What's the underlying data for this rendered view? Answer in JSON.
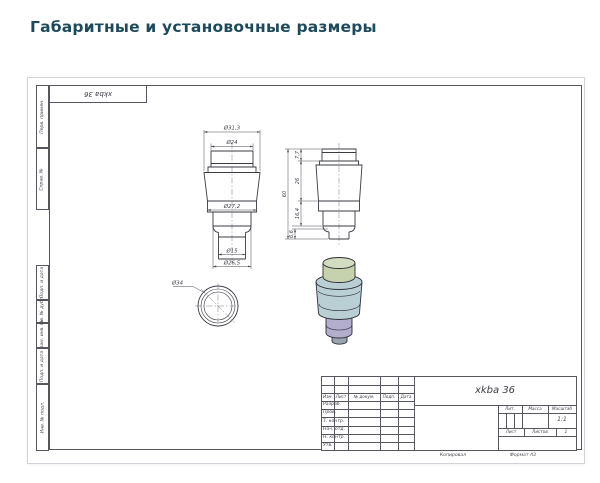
{
  "page": {
    "title": "Габаритные и установочные размеры"
  },
  "sheet": {
    "corner_stamp": "xkba 36",
    "margin_labels": [
      "Перв. примен.",
      "Справ. №",
      "Подп. и дата",
      "Инв. № дубл.",
      "Взам. инв. №",
      "Подп. и дата",
      "Инв. № подл."
    ]
  },
  "drawing": {
    "front_view": {
      "dia_top_outer": "Ø31,3",
      "dia_cap": "Ø24",
      "dia_body": "Ø27,2",
      "dia_stem": "Ø15",
      "dia_lower": "Ø26,5"
    },
    "side_view": {
      "h_total": "60",
      "h_cap": "7,7",
      "h_body": "26",
      "h_lower": "16,4",
      "h_stem": "6,6"
    },
    "bottom_view": {
      "dia_outer": "Ø34"
    },
    "model_colors": {
      "cap": "#cfd8bd",
      "body": "#b9cfd4",
      "lower": "#b3adce"
    }
  },
  "title_block": {
    "doc_name": "xkba 36",
    "header_cols": [
      "Изм.",
      "Лист",
      "№ докум.",
      "Подп.",
      "Дата"
    ],
    "approval_rows": [
      "Разраб.",
      "Пров.",
      "Т. контр.",
      "Нач. отд.",
      "Н. контр.",
      "Утв."
    ],
    "lit_label": "Лит.",
    "mass_label": "Масса",
    "scale_label": "Масштаб",
    "scale_value": "1:1",
    "sheet_label": "Лист",
    "sheets_label": "Листов",
    "sheets_value": "1",
    "copied_label": "Копировал",
    "format_label": "Формат А3"
  }
}
